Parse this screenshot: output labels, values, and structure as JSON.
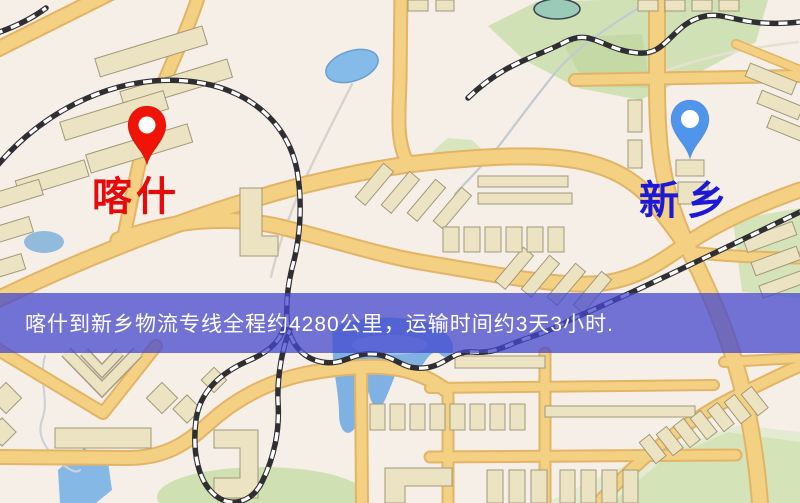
{
  "map": {
    "origin_marker": {
      "city": "喀什",
      "pin_color": "#f01408",
      "label_color": "#e60b0b"
    },
    "destination_marker": {
      "city": "新乡",
      "pin_color": "#4f95ec",
      "label_color": "#1b18d6"
    },
    "banner": {
      "text": "喀什到新乡物流专线全程约4280公里，运输时间约3天3小时.",
      "background_color": "#4648ce",
      "text_color": "#ffffff"
    }
  }
}
